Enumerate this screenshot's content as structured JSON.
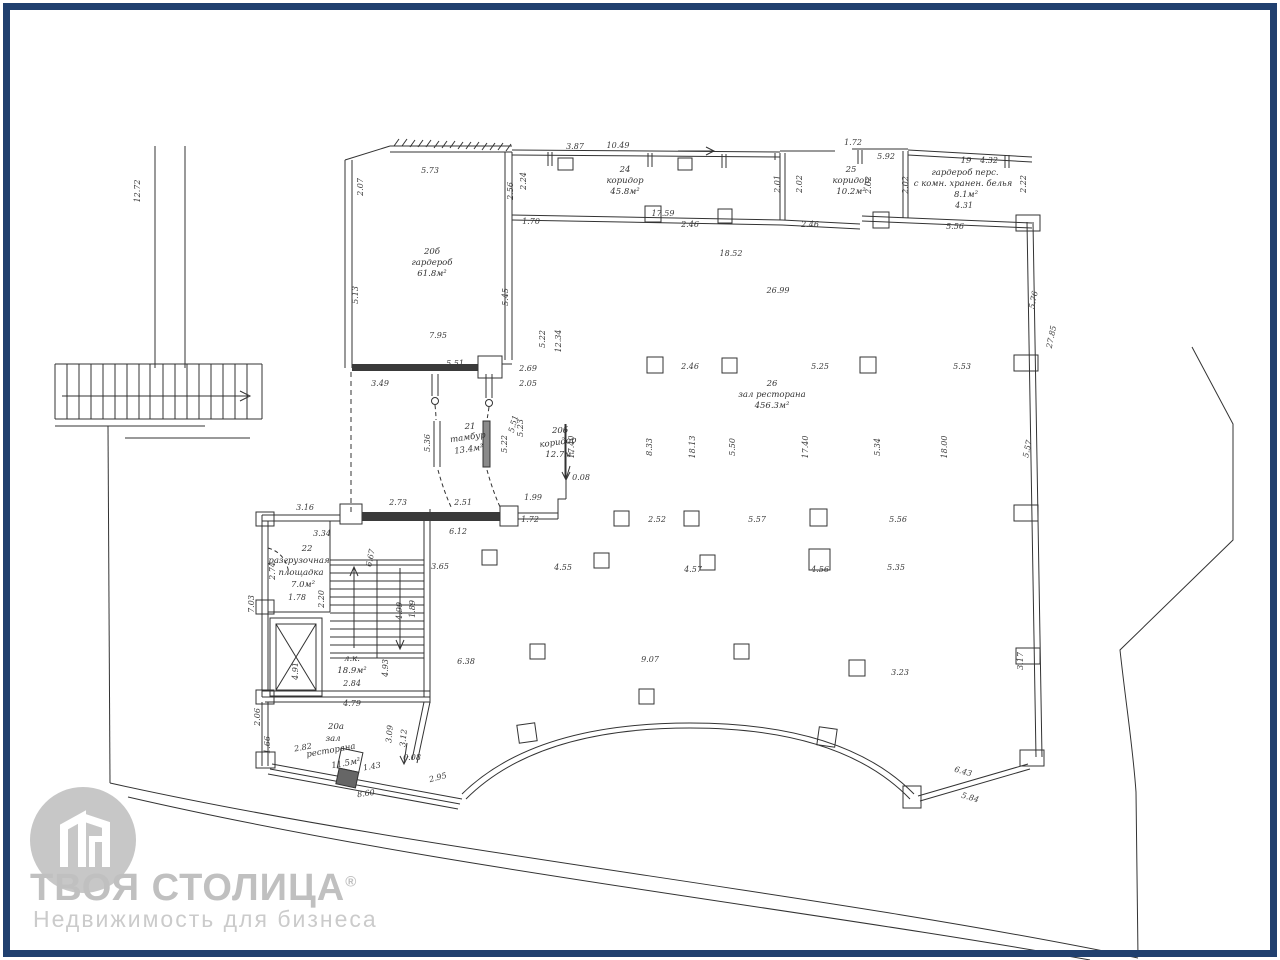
{
  "page": {
    "background": "#ffffff",
    "border_color": "#20406f",
    "line_color": "#333333"
  },
  "logo": {
    "title": "ТВОЯ СТОЛИЦА",
    "registered_mark": "®",
    "subtitle": "Недвижимость для бизнеса"
  },
  "rooms": [
    {
      "number": "19",
      "name": "гардероб перс. с комн. хранен. белья",
      "area": "8.1м²"
    },
    {
      "number": "20а",
      "name": "зал ресторана",
      "area": "11.5м²"
    },
    {
      "number": "20б",
      "name": "гардероб",
      "area": "61.8м²"
    },
    {
      "number": "20б",
      "name": "коридор",
      "area": "12.7м²"
    },
    {
      "number": "21",
      "name": "тамбур",
      "area": "13.4м²"
    },
    {
      "number": "22",
      "name": "разгрузочная площадка",
      "area": "7.0м²"
    },
    {
      "number": "24",
      "name": "коридор",
      "area": "45.8м²"
    },
    {
      "number": "25",
      "name": "коридор",
      "area": "10.2м²"
    },
    {
      "number": "26",
      "name": "зал ресторана",
      "area": "456.3м²"
    },
    {
      "number": "",
      "name": "л.к.",
      "area": "18.9м²"
    }
  ],
  "labels": [
    {
      "t": "3.87",
      "x": 575,
      "y": 147
    },
    {
      "t": "10.49",
      "x": 618,
      "y": 146
    },
    {
      "t": "24",
      "x": 625,
      "y": 170,
      "c": "room"
    },
    {
      "t": "коридор",
      "x": 625,
      "y": 181,
      "c": "room"
    },
    {
      "t": "45.8м²",
      "x": 625,
      "y": 192,
      "c": "room"
    },
    {
      "t": "17.59",
      "x": 663,
      "y": 214
    },
    {
      "t": "2.46",
      "x": 690,
      "y": 225
    },
    {
      "t": "2.46",
      "x": 810,
      "y": 225
    },
    {
      "t": "2.01",
      "x": 778,
      "y": 184,
      "r": -90
    },
    {
      "t": "2.02",
      "x": 800,
      "y": 184,
      "r": -90
    },
    {
      "t": "1.72",
      "x": 853,
      "y": 143
    },
    {
      "t": "5.92",
      "x": 886,
      "y": 157
    },
    {
      "t": "25",
      "x": 851,
      "y": 170,
      "c": "room"
    },
    {
      "t": "коридор",
      "x": 851,
      "y": 181,
      "c": "room"
    },
    {
      "t": "10.2м²",
      "x": 851,
      "y": 192,
      "c": "room"
    },
    {
      "t": "2.02",
      "x": 869,
      "y": 185,
      "r": -90
    },
    {
      "t": "2.02",
      "x": 906,
      "y": 185,
      "r": -90
    },
    {
      "t": "19",
      "x": 966,
      "y": 161,
      "c": "room"
    },
    {
      "t": "4.32",
      "x": 989,
      "y": 161
    },
    {
      "t": "гардероб перс.",
      "x": 965,
      "y": 173,
      "c": "room"
    },
    {
      "t": "с комн. хранен. белья",
      "x": 963,
      "y": 184,
      "c": "room"
    },
    {
      "t": "8.1м²",
      "x": 966,
      "y": 195,
      "c": "room"
    },
    {
      "t": "4.31",
      "x": 964,
      "y": 206
    },
    {
      "t": "2.22",
      "x": 1024,
      "y": 184,
      "r": -90
    },
    {
      "t": "5.56",
      "x": 955,
      "y": 227
    },
    {
      "t": "12.72",
      "x": 138,
      "y": 191,
      "r": -90
    },
    {
      "t": "2.07",
      "x": 361,
      "y": 187,
      "r": -90
    },
    {
      "t": "5.73",
      "x": 430,
      "y": 171
    },
    {
      "t": "2.56",
      "x": 511,
      "y": 191,
      "r": -90
    },
    {
      "t": "2.24",
      "x": 524,
      "y": 181,
      "r": -90
    },
    {
      "t": "1.70",
      "x": 531,
      "y": 222
    },
    {
      "t": "20б",
      "x": 432,
      "y": 252,
      "c": "room"
    },
    {
      "t": "гардероб",
      "x": 432,
      "y": 263,
      "c": "room"
    },
    {
      "t": "61.8м²",
      "x": 432,
      "y": 274,
      "c": "room"
    },
    {
      "t": "5.13",
      "x": 356,
      "y": 295,
      "r": -90
    },
    {
      "t": "5.45",
      "x": 506,
      "y": 297,
      "r": -90
    },
    {
      "t": "7.95",
      "x": 438,
      "y": 336
    },
    {
      "t": "5.22",
      "x": 543,
      "y": 339,
      "r": -90
    },
    {
      "t": "12.34",
      "x": 559,
      "y": 341,
      "r": -90
    },
    {
      "t": "5.51",
      "x": 455,
      "y": 364
    },
    {
      "t": "3.49",
      "x": 380,
      "y": 384
    },
    {
      "t": "2.69",
      "x": 528,
      "y": 369
    },
    {
      "t": "2.05",
      "x": 528,
      "y": 384
    },
    {
      "t": "18.52",
      "x": 731,
      "y": 254
    },
    {
      "t": "26.99",
      "x": 778,
      "y": 291
    },
    {
      "t": "2.46",
      "x": 690,
      "y": 367
    },
    {
      "t": "5.25",
      "x": 820,
      "y": 367
    },
    {
      "t": "5.53",
      "x": 962,
      "y": 367
    },
    {
      "t": "5.76",
      "x": 1034,
      "y": 300,
      "r": -78
    },
    {
      "t": "27.85",
      "x": 1052,
      "y": 337,
      "r": -78
    },
    {
      "t": "26",
      "x": 772,
      "y": 384,
      "c": "room"
    },
    {
      "t": "зал ресторана",
      "x": 772,
      "y": 395,
      "c": "room"
    },
    {
      "t": "456.3м²",
      "x": 772,
      "y": 406,
      "c": "room"
    },
    {
      "t": "8.33",
      "x": 650,
      "y": 447,
      "r": -90
    },
    {
      "t": "18.13",
      "x": 693,
      "y": 447,
      "r": -90
    },
    {
      "t": "5.50",
      "x": 733,
      "y": 447,
      "r": -90
    },
    {
      "t": "17.40",
      "x": 806,
      "y": 447,
      "r": -90
    },
    {
      "t": "5.34",
      "x": 878,
      "y": 447,
      "r": -90
    },
    {
      "t": "18.00",
      "x": 945,
      "y": 447,
      "r": -90
    },
    {
      "t": "5.57",
      "x": 1028,
      "y": 449,
      "r": -78
    },
    {
      "t": "2.52",
      "x": 657,
      "y": 520
    },
    {
      "t": "5.57",
      "x": 757,
      "y": 520
    },
    {
      "t": "5.56",
      "x": 898,
      "y": 520
    },
    {
      "t": "3.65",
      "x": 440,
      "y": 567
    },
    {
      "t": "4.55",
      "x": 563,
      "y": 568
    },
    {
      "t": "4.57",
      "x": 693,
      "y": 570
    },
    {
      "t": "4.56",
      "x": 820,
      "y": 570
    },
    {
      "t": "5.35",
      "x": 896,
      "y": 568
    },
    {
      "t": "6.38",
      "x": 466,
      "y": 662
    },
    {
      "t": "9.07",
      "x": 650,
      "y": 660
    },
    {
      "t": "3.23",
      "x": 900,
      "y": 673
    },
    {
      "t": "3.17",
      "x": 1021,
      "y": 661,
      "r": -90
    },
    {
      "t": "21",
      "x": 470,
      "y": 427,
      "c": "room"
    },
    {
      "t": "тамбур",
      "x": 468,
      "y": 438,
      "c": "room",
      "r": -8
    },
    {
      "t": "13.4м²",
      "x": 469,
      "y": 450,
      "c": "room",
      "r": -8
    },
    {
      "t": "5.36",
      "x": 428,
      "y": 443,
      "r": -90
    },
    {
      "t": "5.23",
      "x": 521,
      "y": 428,
      "r": -90
    },
    {
      "t": "5.22",
      "x": 505,
      "y": 444,
      "r": -90
    },
    {
      "t": "5.51",
      "x": 514,
      "y": 424,
      "r": -75
    },
    {
      "t": "20б",
      "x": 560,
      "y": 431,
      "c": "room"
    },
    {
      "t": "коридор",
      "x": 558,
      "y": 443,
      "c": "room",
      "r": -8
    },
    {
      "t": "12.7м²",
      "x": 560,
      "y": 455,
      "c": "room"
    },
    {
      "t": "17.40",
      "x": 572,
      "y": 447,
      "r": -90
    },
    {
      "t": "0.08",
      "x": 581,
      "y": 478
    },
    {
      "t": "1.99",
      "x": 533,
      "y": 498
    },
    {
      "t": "1.72",
      "x": 530,
      "y": 520
    },
    {
      "t": "2.51",
      "x": 463,
      "y": 503
    },
    {
      "t": "2.73",
      "x": 398,
      "y": 503
    },
    {
      "t": "6.12",
      "x": 458,
      "y": 532
    },
    {
      "t": "3.16",
      "x": 305,
      "y": 508
    },
    {
      "t": "3.34",
      "x": 322,
      "y": 534
    },
    {
      "t": "22",
      "x": 307,
      "y": 549,
      "c": "room"
    },
    {
      "t": "разгрузочная",
      "x": 299,
      "y": 561,
      "c": "room"
    },
    {
      "t": "площадка",
      "x": 301,
      "y": 573,
      "c": "room"
    },
    {
      "t": "7.0м²",
      "x": 303,
      "y": 585,
      "c": "room"
    },
    {
      "t": "1.78",
      "x": 297,
      "y": 598
    },
    {
      "t": "2.74",
      "x": 273,
      "y": 571,
      "r": -90
    },
    {
      "t": "7.03",
      "x": 252,
      "y": 604,
      "r": -90
    },
    {
      "t": "2.20",
      "x": 322,
      "y": 599,
      "r": -90
    },
    {
      "t": "6.67",
      "x": 371,
      "y": 558,
      "r": -78
    },
    {
      "t": "1.89",
      "x": 413,
      "y": 609,
      "r": -90
    },
    {
      "t": "4.99",
      "x": 400,
      "y": 611,
      "r": -90
    },
    {
      "t": "4.91",
      "x": 296,
      "y": 671,
      "r": -90
    },
    {
      "t": "4.93",
      "x": 386,
      "y": 668,
      "r": -90
    },
    {
      "t": "л.к.",
      "x": 352,
      "y": 659,
      "c": "room"
    },
    {
      "t": "18.9м²",
      "x": 352,
      "y": 671,
      "c": "room"
    },
    {
      "t": "2.84",
      "x": 352,
      "y": 684
    },
    {
      "t": "2.06",
      "x": 258,
      "y": 717,
      "r": -90
    },
    {
      "t": "1.66",
      "x": 268,
      "y": 745,
      "r": -90
    },
    {
      "t": "4.79",
      "x": 352,
      "y": 704
    },
    {
      "t": "20а",
      "x": 336,
      "y": 727,
      "c": "room"
    },
    {
      "t": "зал",
      "x": 333,
      "y": 739,
      "c": "room"
    },
    {
      "t": "ресторана",
      "x": 331,
      "y": 751,
      "c": "room",
      "r": -10
    },
    {
      "t": "11.5м²",
      "x": 346,
      "y": 764,
      "c": "room",
      "r": -10
    },
    {
      "t": "2.82",
      "x": 303,
      "y": 748,
      "r": -10
    },
    {
      "t": "3.09",
      "x": 390,
      "y": 734,
      "r": -85
    },
    {
      "t": "3.12",
      "x": 404,
      "y": 738,
      "r": -85
    },
    {
      "t": "0.08",
      "x": 412,
      "y": 758
    },
    {
      "t": "1.43",
      "x": 372,
      "y": 767,
      "r": -10
    },
    {
      "t": "8.60",
      "x": 366,
      "y": 794,
      "r": -8
    },
    {
      "t": "2.95",
      "x": 438,
      "y": 778,
      "r": -15
    },
    {
      "t": "6.43",
      "x": 963,
      "y": 772,
      "r": 16
    },
    {
      "t": "5.84",
      "x": 970,
      "y": 798,
      "r": 16
    }
  ]
}
